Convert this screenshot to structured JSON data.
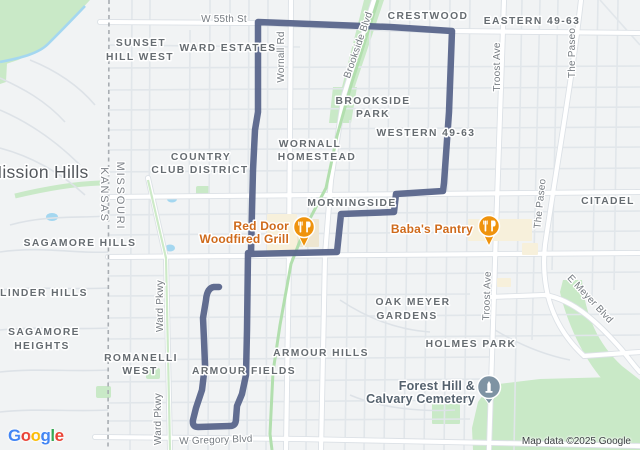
{
  "labels": {
    "w55th": "W 55th St",
    "sunset1": "SUNSET",
    "sunset2": "HILL WEST",
    "ward_estates": "WARD ESTATES",
    "crestwood": "CRESTWOOD",
    "eastern": "EASTERN 49-63",
    "wornall_rd": "Wornall Rd",
    "brookside_blvd": "Brookside Blvd",
    "brookside_park1": "BROOKSIDE",
    "brookside_park2": "PARK",
    "western": "WESTERN 49-63",
    "wornall_h1": "WORNALL",
    "wornall_h2": "HOMESTEAD",
    "mission_hills": "Mission Hills",
    "country1": "COUNTRY",
    "country2": "CLUB DISTRICT",
    "missouri": "MISSOURI",
    "kansas": "KANSAS",
    "morningside": "MORNINGSIDE",
    "citadel": "CITADEL",
    "the_paseo_top": "The Paseo",
    "the_paseo_mid": "The Paseo",
    "troost_top": "Troost Ave",
    "troost_bottom": "Troost Ave",
    "sagamore_hills": "SAGAMORE HILLS",
    "linder_hills": "LINDER HILLS",
    "sagamore_h1": "SAGAMORE",
    "sagamore_h2": "HEIGHTS",
    "romanelli1": "ROMANELLI",
    "romanelli2": "WEST",
    "oak_meyer1": "OAK MEYER",
    "oak_meyer2": "GARDENS",
    "armour_hills": "ARMOUR HILLS",
    "armour_fields": "ARMOUR FIELDS",
    "holmes_park": "HOLMES PARK",
    "ward_pkwy_top": "Ward Pkwy",
    "ward_pkwy_bottom": "Ward Pkwy",
    "e_meyer": "E Meyer Blvd",
    "w_gregory": "W Gregory Blvd"
  },
  "pois": {
    "red_door_l1": "Red Door",
    "red_door_l2": "Woodfired Grill",
    "babas": "Baba's Pantry",
    "forest_l1": "Forest Hill &",
    "forest_l2": "Calvary Cemetery"
  },
  "logo": {
    "l1": "G",
    "l2": "o",
    "l3": "o",
    "l4": "g",
    "l5": "l",
    "l6": "e"
  },
  "attribution": "Map data ©2025 Google",
  "colors": {
    "route": "#59658B",
    "restaurant_pin": "#EF930D",
    "cemetery_pin": "#7E93A3",
    "park_green": "#c9e9c7",
    "water_blue": "#a4d7f0",
    "background": "#f1f3f4",
    "poi_text_orange": "#cf6a1b"
  }
}
